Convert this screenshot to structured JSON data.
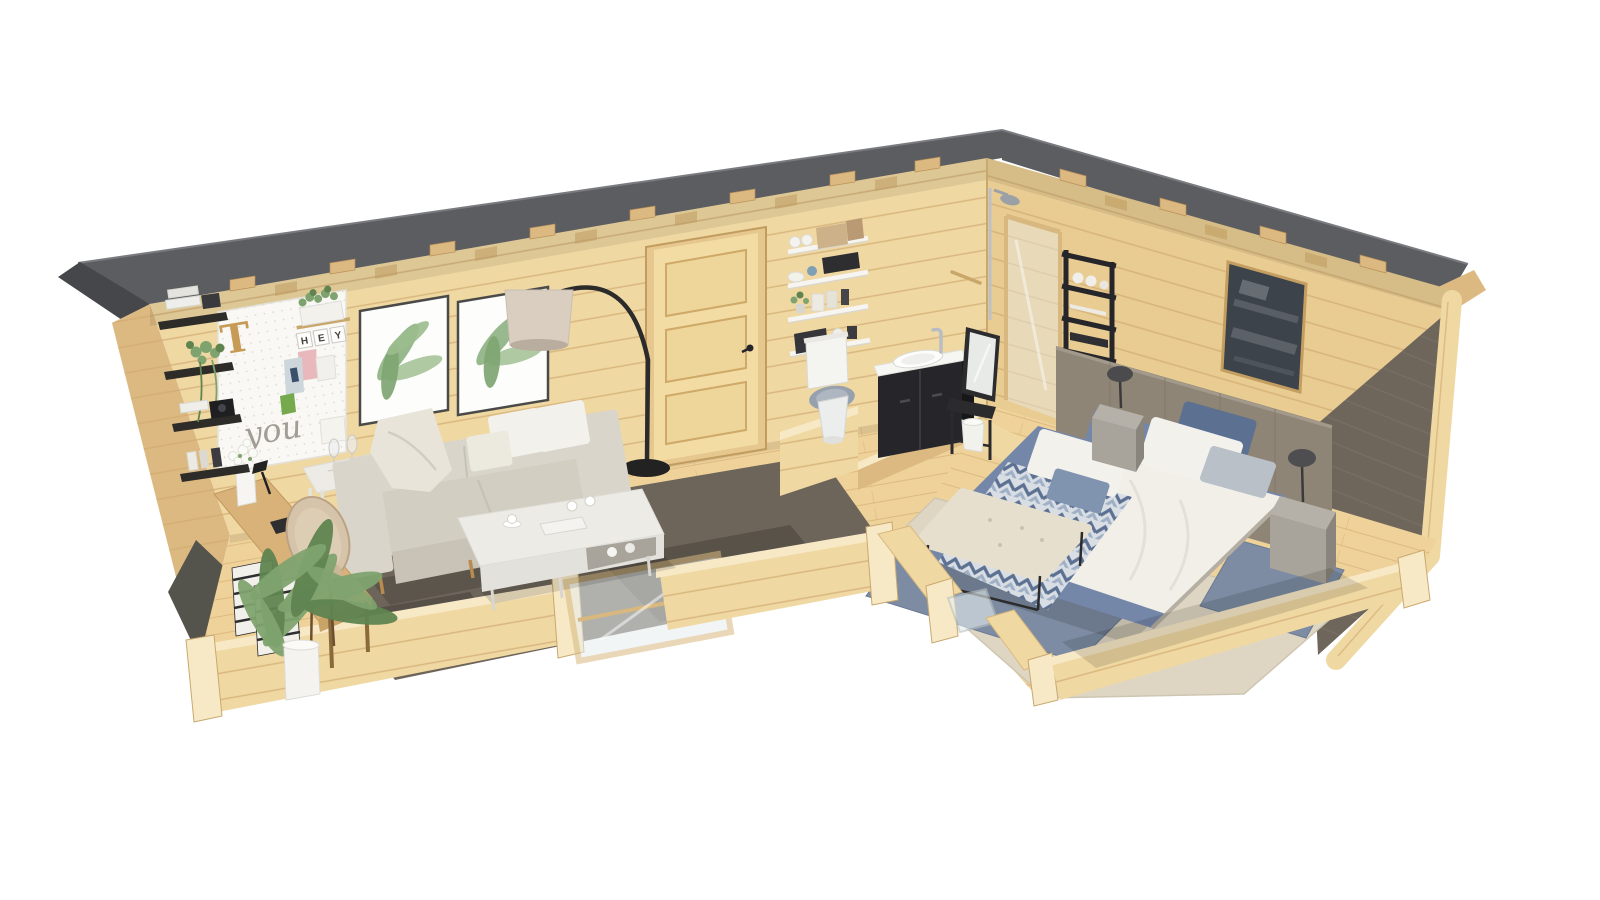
{
  "pegboard": {
    "letter": "T",
    "tiles": [
      "H",
      "E",
      "Y"
    ],
    "script": "you"
  },
  "palette": {
    "bg": "#ffffff",
    "roof": "#5c5d61",
    "roofDark": "#46474b",
    "wood": "#f0d8a2",
    "woodWing": "#e9cc92",
    "woodDark": "#ddb982",
    "woodTrim": "#c9a76b",
    "plank": "#cfa96f",
    "cut": "#f7e9c6",
    "floor": "#eed29a",
    "floorLine": "#d9b478",
    "rug": "#6d645a",
    "sofa": "#d9d5ca",
    "sofaShade": "#c7c2b5",
    "pillowWhite": "#f3f1ec",
    "throwBeige": "#e8e4d9",
    "tableWhite": "#edebe6",
    "deskWood": "#d8b279",
    "chairBeige": "#d5c4aa",
    "headboard": "#8e8577",
    "artDark": "#3d434a",
    "gold": "#c49e60",
    "duvet": "#f2efe9",
    "blue": "#7587a9",
    "blueDeep": "#5c7092",
    "chevBase": "#d8dee4",
    "carpet": "#ded6c3",
    "blueRug": "#7d8ca3",
    "blueRugDark": "#64748f",
    "stone": "#a9a49b",
    "stoneDark": "#8a857c",
    "stoneLight": "#b6b1a8",
    "black": "#26262a",
    "green": "#7fa36f",
    "greenDeep": "#5f8450",
    "lampShade": "#d9cec0",
    "chrome": "#bcc1c8",
    "glass": "#e7eef0",
    "sideWallDark": "#6f665b",
    "white": "#f4f3ef"
  }
}
